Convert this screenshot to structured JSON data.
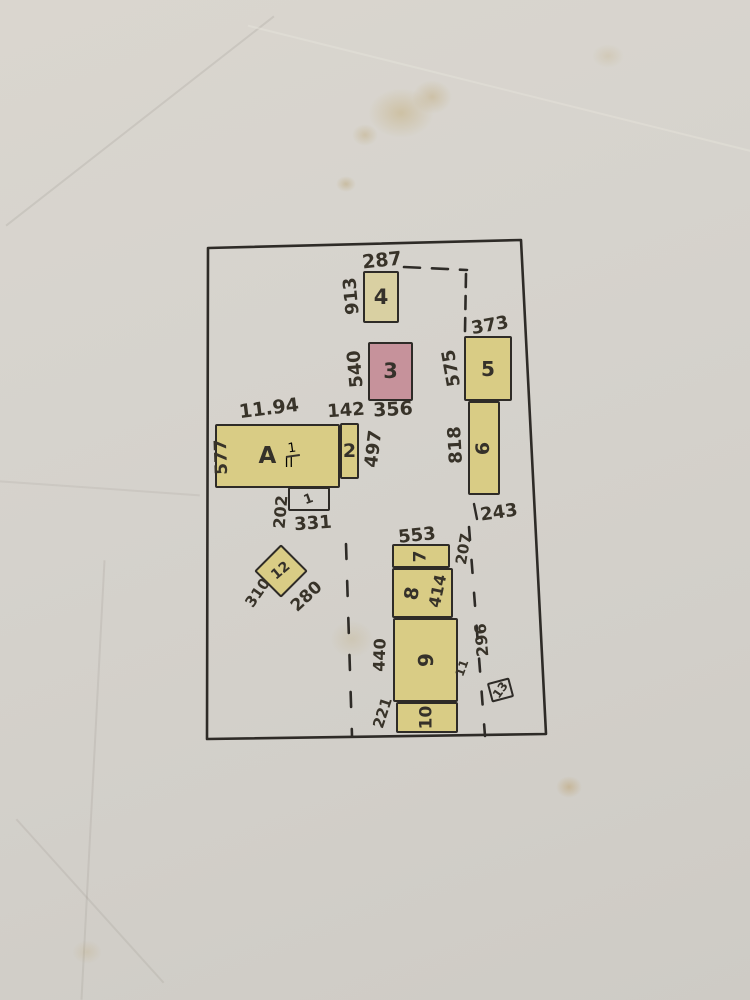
{
  "colors": {
    "ink": "#2e2b27",
    "yellow": "#d9cc85",
    "beige": "#d9d0a2",
    "pink": "#c6929b",
    "paper": "transparent"
  },
  "plan": {
    "boundary": {
      "points": "208,248 521,240 546,734 207,739"
    },
    "dashed_lines": [
      {
        "d": "M404 267 L467 270",
        "dash": "16 12"
      },
      {
        "d": "M466 274 L465 331",
        "dash": "13 9"
      },
      {
        "d": "M346 544 L352 736",
        "dash": "15 22"
      },
      {
        "d": "M469 527 L485 736",
        "dash": "13 20"
      }
    ],
    "ticks": [
      {
        "x1": 474,
        "y1": 504,
        "x2": 477,
        "y2": 519
      }
    ],
    "buildings": [
      {
        "id": "A",
        "label": "A",
        "frac_num": "1",
        "frac_den": "II",
        "x": 215,
        "y": 424,
        "w": 125,
        "h": 64,
        "fill": "yellow",
        "rot": 0,
        "label_rot": 0,
        "fs": 23
      },
      {
        "id": "2",
        "label": "2",
        "x": 340,
        "y": 423,
        "w": 19,
        "h": 56,
        "fill": "yellow",
        "rot": 0,
        "label_rot": 0,
        "fs": 19
      },
      {
        "id": "1",
        "label": "1",
        "x": 288,
        "y": 487,
        "w": 42,
        "h": 24,
        "fill": "paper",
        "rot": 0,
        "label_rot": -20,
        "fs": 13
      },
      {
        "id": "12",
        "label": "12",
        "x": 262,
        "y": 552,
        "w": 38,
        "h": 38,
        "fill": "yellow",
        "rot": 45,
        "label_rot": -85,
        "fs": 14
      },
      {
        "id": "4",
        "label": "4",
        "x": 363,
        "y": 271,
        "w": 36,
        "h": 52,
        "fill": "beige",
        "rot": 0,
        "label_rot": 0,
        "fs": 21
      },
      {
        "id": "3",
        "label": "3",
        "x": 368,
        "y": 342,
        "w": 45,
        "h": 59,
        "fill": "pink",
        "rot": 0,
        "label_rot": 0,
        "fs": 21
      },
      {
        "id": "5",
        "label": "5",
        "x": 464,
        "y": 336,
        "w": 48,
        "h": 65,
        "fill": "yellow",
        "rot": 0,
        "label_rot": 0,
        "fs": 20
      },
      {
        "id": "6",
        "label": "6",
        "x": 468,
        "y": 401,
        "w": 32,
        "h": 94,
        "fill": "yellow",
        "rot": 0,
        "label_rot": -90,
        "fs": 19
      },
      {
        "id": "7",
        "label": "7",
        "x": 392,
        "y": 544,
        "w": 58,
        "h": 24,
        "fill": "yellow",
        "rot": 0,
        "label_rot": -90,
        "fs": 17
      },
      {
        "id": "8",
        "label": "8",
        "x": 392,
        "y": 568,
        "w": 61,
        "h": 50,
        "fill": "yellow",
        "rot": 0,
        "label_rot": -80,
        "fs": 19,
        "label_dx": -10
      },
      {
        "id": "9",
        "label": "9",
        "x": 393,
        "y": 618,
        "w": 65,
        "h": 84,
        "fill": "yellow",
        "rot": 0,
        "label_rot": -90,
        "fs": 20
      },
      {
        "id": "10",
        "label": "10",
        "x": 396,
        "y": 702,
        "w": 62,
        "h": 31,
        "fill": "yellow",
        "rot": 0,
        "label_rot": -90,
        "fs": 17
      },
      {
        "id": "13",
        "label": "13",
        "x": 489,
        "y": 680,
        "w": 23,
        "h": 20,
        "fill": "paper",
        "rot": -15,
        "label_rot": -40,
        "fs": 12
      }
    ],
    "dims": [
      {
        "text": "287",
        "x": 382,
        "y": 261,
        "rot": -6,
        "fs": 19
      },
      {
        "text": "913",
        "x": 352,
        "y": 296,
        "rot": -95,
        "fs": 18
      },
      {
        "text": "540",
        "x": 356,
        "y": 369,
        "rot": -95,
        "fs": 18
      },
      {
        "text": "142",
        "x": 346,
        "y": 411,
        "rot": -4,
        "fs": 18
      },
      {
        "text": "356",
        "x": 393,
        "y": 410,
        "rot": -3,
        "fs": 19
      },
      {
        "text": "373",
        "x": 490,
        "y": 326,
        "rot": -10,
        "fs": 18
      },
      {
        "text": "575",
        "x": 452,
        "y": 368,
        "rot": -100,
        "fs": 18
      },
      {
        "text": "818",
        "x": 456,
        "y": 445,
        "rot": -93,
        "fs": 18
      },
      {
        "text": "243",
        "x": 499,
        "y": 513,
        "rot": -8,
        "fs": 18
      },
      {
        "text": "11.94",
        "x": 269,
        "y": 409,
        "rot": -7,
        "fs": 19
      },
      {
        "text": "577",
        "x": 222,
        "y": 457,
        "rot": -92,
        "fs": 17
      },
      {
        "text": "497",
        "x": 374,
        "y": 449,
        "rot": -83,
        "fs": 18
      },
      {
        "text": "202",
        "x": 281,
        "y": 512,
        "rot": -85,
        "fs": 16
      },
      {
        "text": "331",
        "x": 313,
        "y": 524,
        "rot": -4,
        "fs": 18
      },
      {
        "text": "310",
        "x": 258,
        "y": 593,
        "rot": -55,
        "fs": 15
      },
      {
        "text": "280",
        "x": 307,
        "y": 597,
        "rot": -43,
        "fs": 17
      },
      {
        "text": "553",
        "x": 417,
        "y": 536,
        "rot": -6,
        "fs": 18
      },
      {
        "text": "207",
        "x": 464,
        "y": 549,
        "rot": -80,
        "fs": 15
      },
      {
        "text": "414",
        "x": 438,
        "y": 591,
        "rot": -78,
        "fs": 16
      },
      {
        "text": "440",
        "x": 380,
        "y": 655,
        "rot": -88,
        "fs": 16
      },
      {
        "text": "221",
        "x": 383,
        "y": 713,
        "rot": -72,
        "fs": 15
      },
      {
        "text": "296",
        "x": 482,
        "y": 640,
        "rot": -95,
        "fs": 16
      },
      {
        "text": "11",
        "x": 462,
        "y": 668,
        "rot": -70,
        "fs": 12
      }
    ]
  }
}
